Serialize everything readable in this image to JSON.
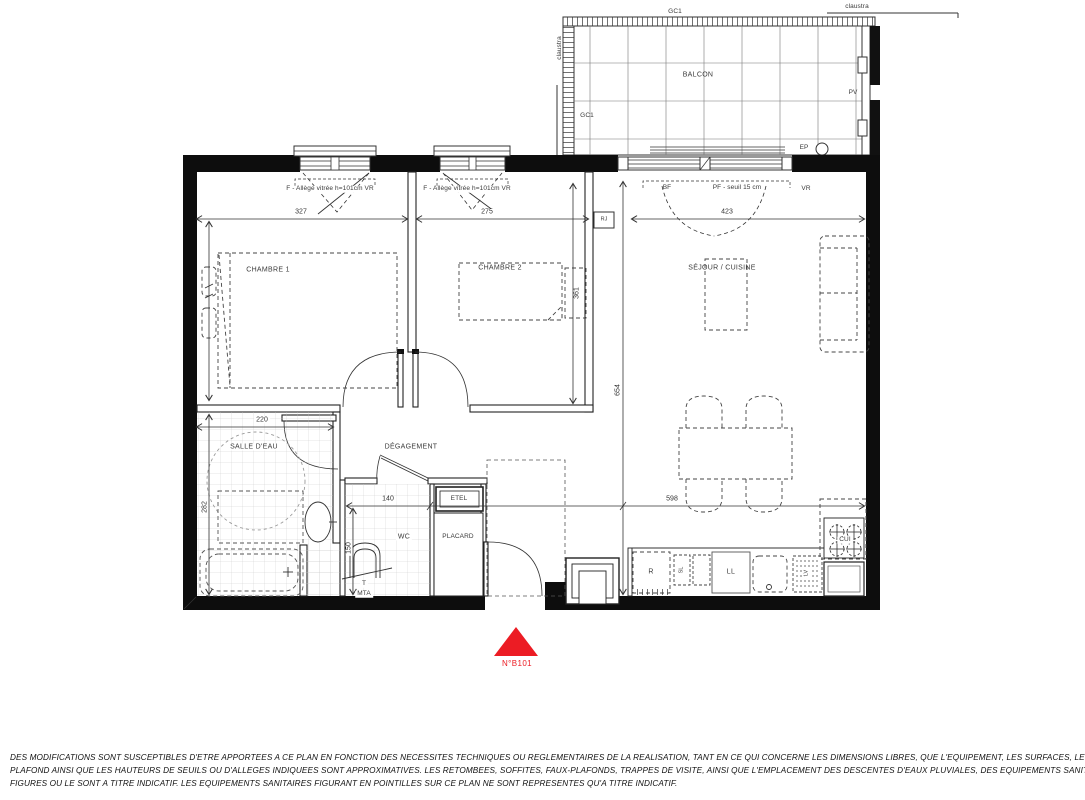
{
  "plan": {
    "balcony": {
      "label": "BALCON",
      "gc1_top": "GC1",
      "gc1_side": "GC1",
      "claustra_top": "claustra",
      "claustra_left": "claustra",
      "pv": "PV",
      "ep": "EP"
    },
    "windows": {
      "ch1_window": "F - Allège vitrée h=101cm VR",
      "ch2_window": "F - Allège vitrée h=101cm VR",
      "bf": "BF",
      "pf": "PF - seuil 15 cm",
      "vr": "VR",
      "rj": "RJ"
    },
    "rooms": {
      "ch1": "CHAMBRE 1",
      "ch2": "CHAMBRE 2",
      "sejour": "SÉJOUR / CUISINE",
      "sde": "SALLE D'EAU",
      "degagement": "DÉGAGEMENT",
      "wc": "WC",
      "placard": "PLACARD",
      "etel": "ETEL",
      "t": "T",
      "mta": "MTA"
    },
    "kitchen": {
      "fridge": "R",
      "sl": "SL",
      "washer": "LL",
      "dishwasher": "LV",
      "cooktop": "CUI"
    },
    "dims": {
      "d327": "327",
      "d275": "275",
      "d423": "423",
      "d220": "220",
      "d140": "140",
      "d598": "598",
      "d654": "654",
      "d361": "361",
      "d282": "282",
      "d150": "150"
    },
    "unit": {
      "number": "N°B101"
    },
    "colors": {
      "accent_red": "#ec1c24",
      "line": "#1a1a1a"
    }
  },
  "disclaimer": {
    "line1": "DES MODIFICATIONS SONT SUSCEPTIBLES D'ETRE APPORTEES A CE PLAN EN FONCTION DES NECESSITES TECHNIQUES OU REGLEMENTAIRES DE LA REALISATION, TANT EN CE QUI CONCERNE LES DIMENSIONS LIBRES, QUE L'EQUIPEMENT, LES SURFACES, LES HAUTEURS SOUS",
    "line2": "PLAFOND AINSI QUE LES HAUTEURS DE SEUILS OU D'ALLEGES INDIQUEES SONT APPROXIMATIVES. LES RETOMBEES, SOFFITES, FAUX-PLAFONDS, TRAPPES DE VISITE, AINSI QUE L'EMPLACEMENT DES DESCENTES D'EAUX PLUVIALES, DES EQUIPEMENTS SANITAIRES, NE SONT PAS TOUS",
    "line3": "FIGURES OU LE SONT A TITRE INDICATIF. LES EQUIPEMENTS SANITAIRES FIGURANT EN POINTILLES SUR CE PLAN NE SONT REPRESENTES QU'A TITRE INDICATIF."
  }
}
